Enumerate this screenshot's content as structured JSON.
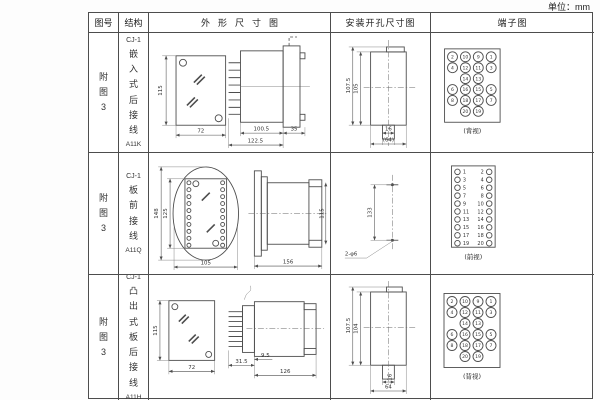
{
  "unit_label": "单位：mm",
  "colors": {
    "line": "#4d4d4d",
    "text": "#333333"
  },
  "header": {
    "fig": "图号",
    "structure": "结构",
    "outline": "外形尺寸图",
    "mounting": "安装开孔尺寸图",
    "terminal": "端子图"
  },
  "rows": [
    {
      "fig_no": "附图3",
      "model": "CJ-1",
      "structure": "嵌入式后接线",
      "code": "A11K",
      "outline": {
        "h": "115",
        "w": "72",
        "body": "100.5",
        "total": "122.5",
        "rear": "35"
      },
      "mounting": {
        "d1": "107.5",
        "d2": "105",
        "d3": "16",
        "d4": "(64)"
      },
      "terminal": {
        "label": "(背视)",
        "n": [
          "2",
          "10",
          "9",
          "1",
          "4",
          "12",
          "11",
          "3",
          "14",
          "13",
          "6",
          "16",
          "15",
          "5",
          "8",
          "18",
          "17",
          "7",
          "20",
          "19"
        ]
      }
    },
    {
      "fig_no": "附图3",
      "model": "CJ-1",
      "structure": "板前接线",
      "code": "A11Q",
      "outline": {
        "h": "148",
        "inner": "125",
        "w": "105",
        "depth": "156",
        "side_h": "115"
      },
      "mounting": {
        "d1": "133",
        "holes": "2-φ6"
      },
      "terminal": {
        "label": "(前视)",
        "n": [
          "1",
          "2",
          "3",
          "4",
          "5",
          "6",
          "7",
          "8",
          "9",
          "10",
          "11",
          "12",
          "13",
          "14",
          "15",
          "16",
          "17",
          "18",
          "19",
          "20"
        ]
      }
    },
    {
      "fig_no": "附图3",
      "model": "CJ-1",
      "structure": "凸出式板后接线",
      "code": "A11H",
      "outline": {
        "h": "115",
        "w": "72",
        "d1": "31.5",
        "d2": "9.5",
        "d3": "126"
      },
      "mounting": {
        "d1": "107.5",
        "d2": "104",
        "d3": "16",
        "d4": "64"
      },
      "terminal": {
        "label": "(背视)",
        "n": [
          "2",
          "10",
          "9",
          "1",
          "4",
          "12",
          "11",
          "3",
          "14",
          "13",
          "6",
          "16",
          "15",
          "5",
          "8",
          "18",
          "17",
          "7",
          "20",
          "19"
        ]
      }
    }
  ]
}
